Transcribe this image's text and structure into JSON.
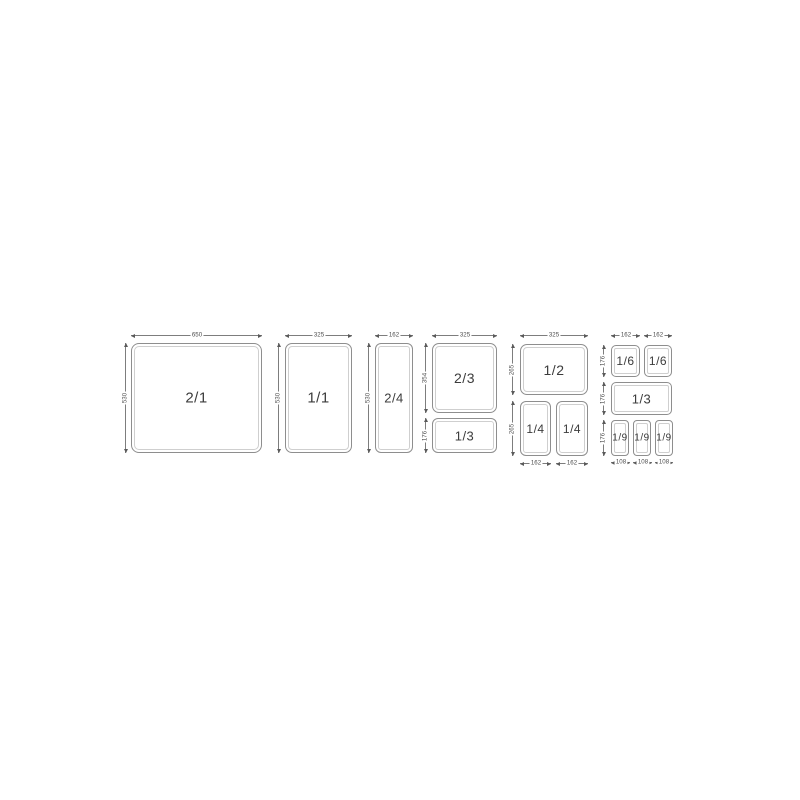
{
  "diagram": {
    "background": "#ffffff",
    "box_border_color": "#8e8e8e",
    "box_inner_line_color": "#cfcfcf",
    "dim_line_color": "#7d7d7d",
    "dim_text_color": "#4d4d4d",
    "box_label_color": "#3c3c3c",
    "panels": [
      {
        "name": "gn-2-1",
        "boxes": [
          {
            "label": "2/1",
            "x": 131,
            "y": 343,
            "w": 131,
            "h": 110,
            "r": 8,
            "fs": 15
          }
        ],
        "dims": [
          {
            "text": "650",
            "o": "h",
            "x": 131,
            "y": 335,
            "len": 131
          },
          {
            "text": "530",
            "o": "v",
            "x": 125,
            "y": 343,
            "len": 110
          }
        ]
      },
      {
        "name": "gn-1-1",
        "boxes": [
          {
            "label": "1/1",
            "x": 285,
            "y": 343,
            "w": 67,
            "h": 110,
            "r": 7,
            "fs": 15
          }
        ],
        "dims": [
          {
            "text": "325",
            "o": "h",
            "x": 285,
            "y": 335,
            "len": 67
          },
          {
            "text": "530",
            "o": "v",
            "x": 278,
            "y": 343,
            "len": 110
          }
        ]
      },
      {
        "name": "gn-2-4",
        "boxes": [
          {
            "label": "2/4",
            "x": 375,
            "y": 343,
            "w": 38,
            "h": 110,
            "r": 6,
            "fs": 13
          }
        ],
        "dims": [
          {
            "text": "162",
            "o": "h",
            "x": 375,
            "y": 335,
            "len": 38
          },
          {
            "text": "530",
            "o": "v",
            "x": 368,
            "y": 343,
            "len": 110
          }
        ]
      },
      {
        "name": "gn-2-3-and-1-3",
        "boxes": [
          {
            "label": "2/3",
            "x": 432,
            "y": 343,
            "w": 65,
            "h": 70,
            "r": 7,
            "fs": 14
          },
          {
            "label": "1/3",
            "x": 432,
            "y": 418,
            "w": 65,
            "h": 35,
            "r": 6,
            "fs": 13
          }
        ],
        "dims": [
          {
            "text": "325",
            "o": "h",
            "x": 432,
            "y": 335,
            "len": 65
          },
          {
            "text": "354",
            "o": "v",
            "x": 425,
            "y": 343,
            "len": 70
          },
          {
            "text": "176",
            "o": "v",
            "x": 425,
            "y": 418,
            "len": 35
          }
        ]
      },
      {
        "name": "gn-1-2-and-1-4",
        "boxes": [
          {
            "label": "1/2",
            "x": 520,
            "y": 344,
            "w": 68,
            "h": 51,
            "r": 7,
            "fs": 14
          },
          {
            "label": "1/4",
            "x": 520,
            "y": 401,
            "w": 31,
            "h": 55,
            "r": 6,
            "fs": 12
          },
          {
            "label": "1/4",
            "x": 556,
            "y": 401,
            "w": 32,
            "h": 55,
            "r": 6,
            "fs": 12
          }
        ],
        "dims": [
          {
            "text": "325",
            "o": "h",
            "x": 520,
            "y": 335,
            "len": 68
          },
          {
            "text": "265",
            "o": "v",
            "x": 512,
            "y": 344,
            "len": 51
          },
          {
            "text": "265",
            "o": "v",
            "x": 512,
            "y": 401,
            "len": 55
          },
          {
            "text": "162",
            "o": "h",
            "x": 520,
            "y": 463,
            "len": 31
          },
          {
            "text": "162",
            "o": "h",
            "x": 556,
            "y": 463,
            "len": 32
          }
        ]
      },
      {
        "name": "gn-1-6-1-3-1-9",
        "boxes": [
          {
            "label": "1/6",
            "x": 611,
            "y": 345,
            "w": 29,
            "h": 32,
            "r": 5,
            "fs": 12
          },
          {
            "label": "1/6",
            "x": 644,
            "y": 345,
            "w": 28,
            "h": 32,
            "r": 5,
            "fs": 12
          },
          {
            "label": "1/3",
            "x": 611,
            "y": 382,
            "w": 61,
            "h": 33,
            "r": 5,
            "fs": 13
          },
          {
            "label": "1/9",
            "x": 611,
            "y": 420,
            "w": 18,
            "h": 36,
            "r": 4,
            "fs": 10
          },
          {
            "label": "1/9",
            "x": 633,
            "y": 420,
            "w": 18,
            "h": 36,
            "r": 4,
            "fs": 10
          },
          {
            "label": "1/9",
            "x": 655,
            "y": 420,
            "w": 18,
            "h": 36,
            "r": 4,
            "fs": 10
          }
        ],
        "dims": [
          {
            "text": "162",
            "o": "h",
            "x": 611,
            "y": 335,
            "len": 29
          },
          {
            "text": "162",
            "o": "h",
            "x": 644,
            "y": 335,
            "len": 28
          },
          {
            "text": "176",
            "o": "v",
            "x": 603,
            "y": 345,
            "len": 32
          },
          {
            "text": "176",
            "o": "v",
            "x": 603,
            "y": 382,
            "len": 33
          },
          {
            "text": "176",
            "o": "v",
            "x": 603,
            "y": 420,
            "len": 36
          },
          {
            "text": "108",
            "o": "h",
            "x": 611,
            "y": 462,
            "len": 19
          },
          {
            "text": "108",
            "o": "h",
            "x": 633,
            "y": 462,
            "len": 19
          },
          {
            "text": "108",
            "o": "h",
            "x": 655,
            "y": 462,
            "len": 18
          }
        ]
      }
    ]
  }
}
